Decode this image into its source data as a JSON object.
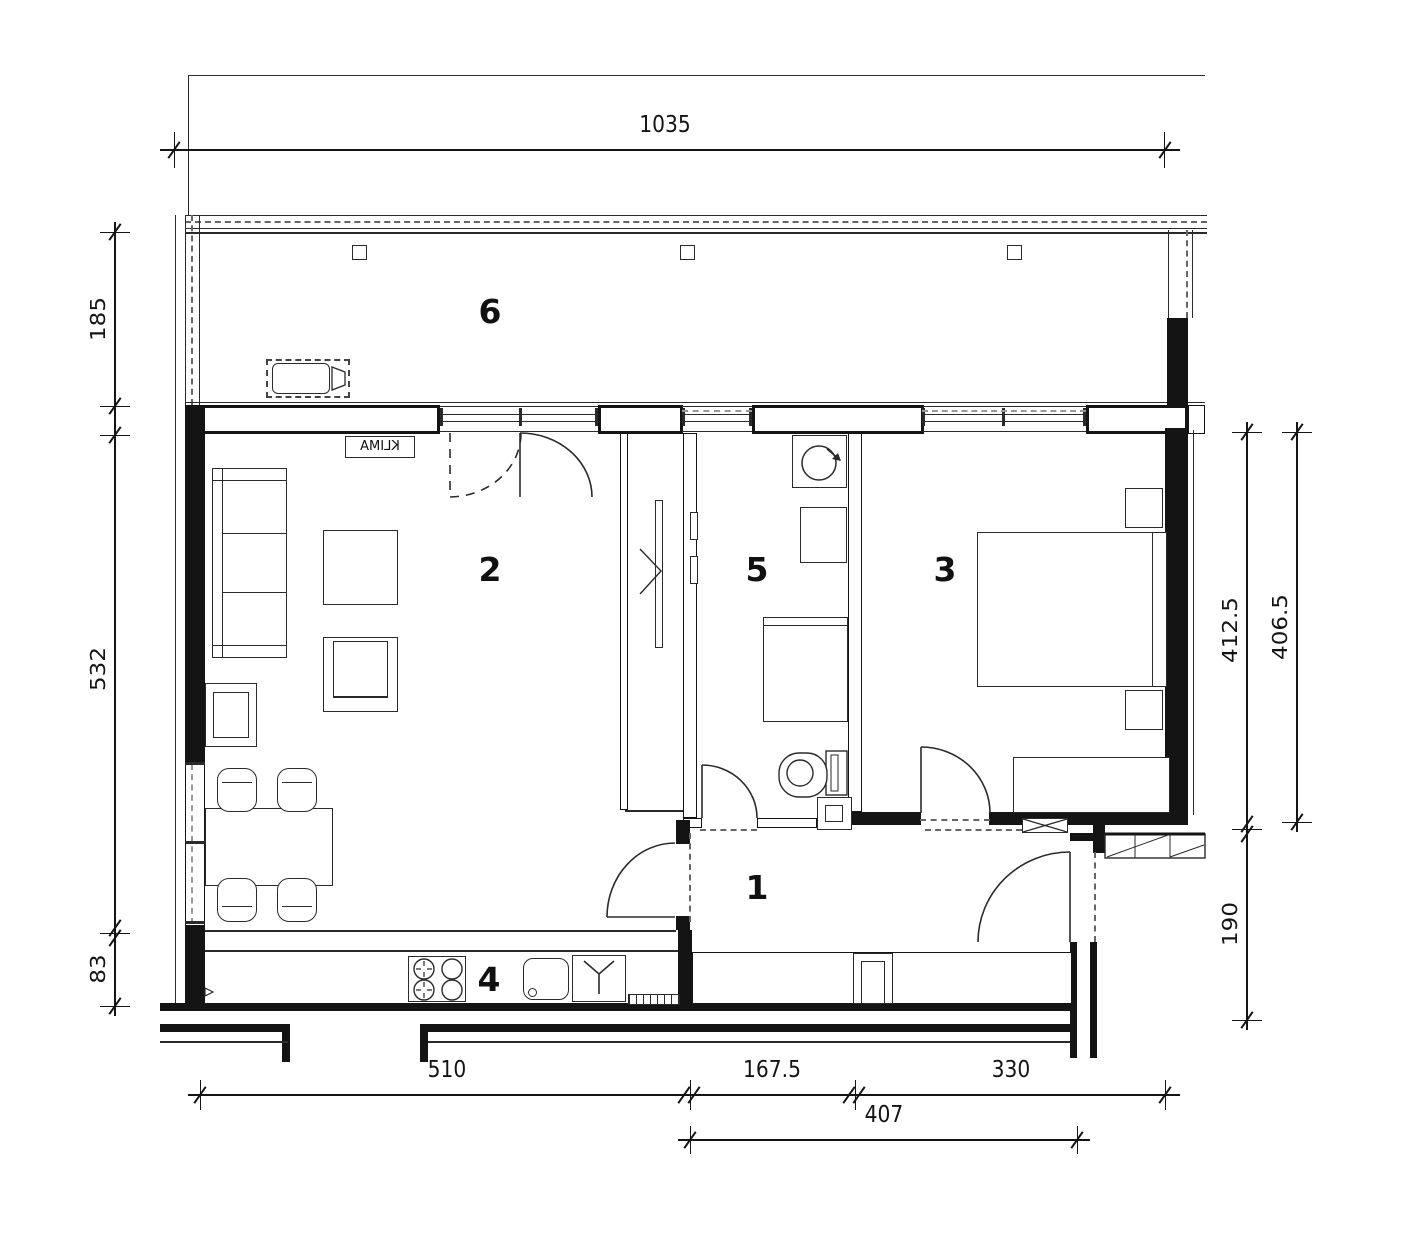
{
  "rooms": {
    "hall": "1",
    "living": "2",
    "bedroom": "3",
    "kitchen": "4",
    "bathroom": "5",
    "balcony": "6"
  },
  "labels": {
    "klima": "KLIMA"
  },
  "dims": {
    "top_width": "1035",
    "balcony_depth": "185",
    "living_depth": "532",
    "kitchen_depth": "83",
    "bedroom_depth_inner": "412.5",
    "bedroom_depth_outer": "406.5",
    "entry_depth": "190",
    "living_width": "510",
    "bath_width": "167.5",
    "bedroom_width": "330",
    "hall_width": "407"
  }
}
